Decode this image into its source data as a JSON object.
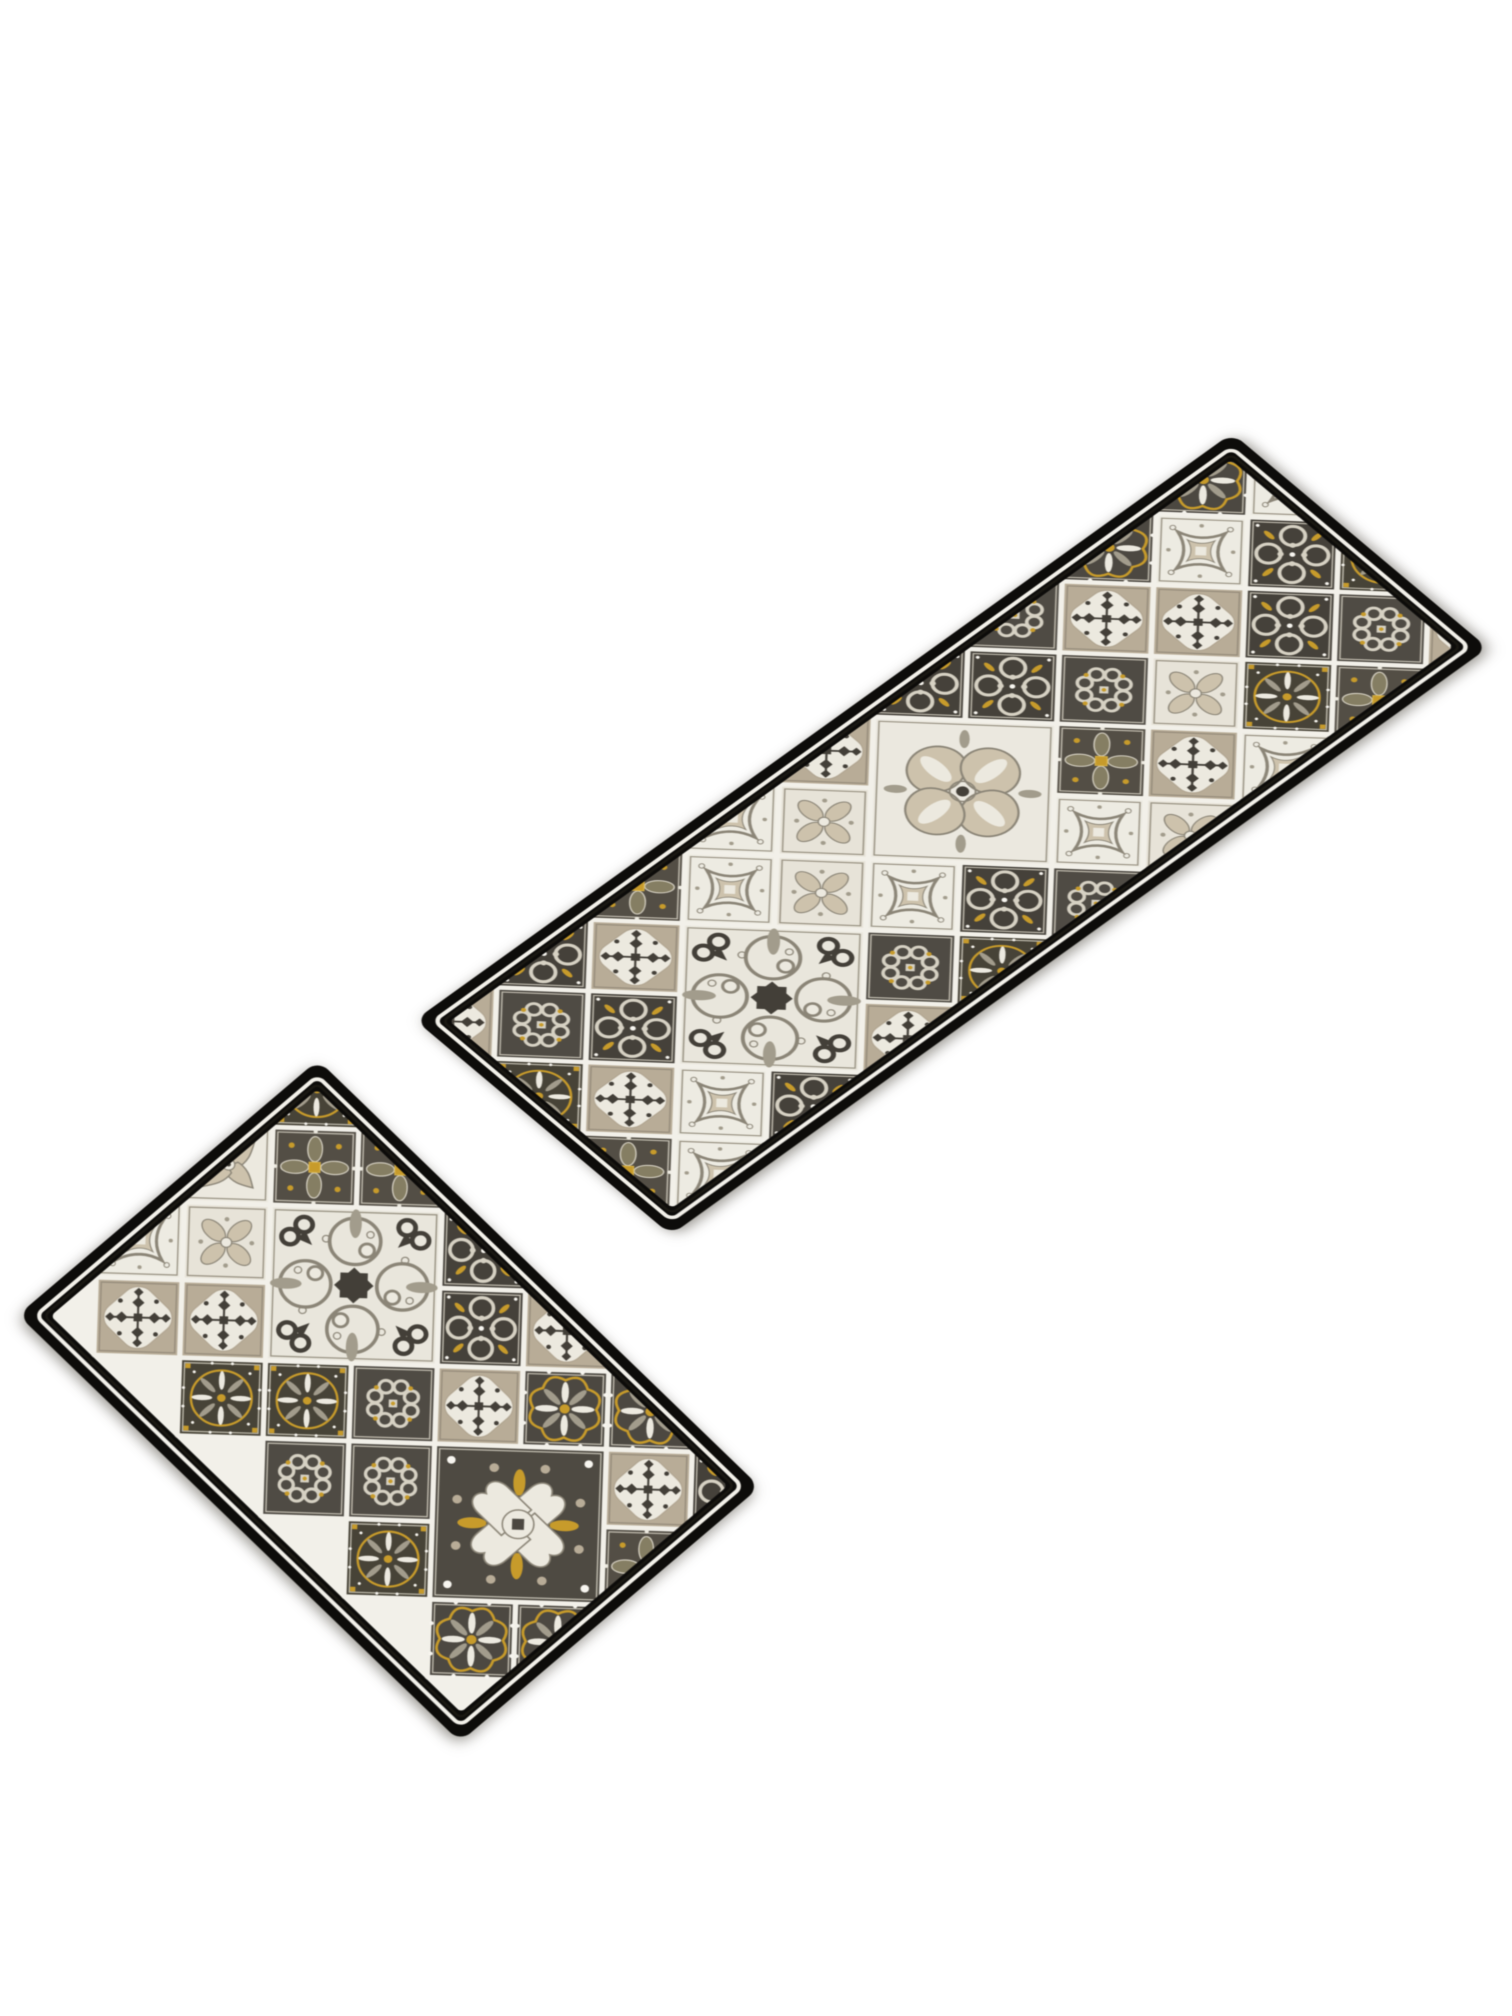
{
  "scene": {
    "subject": "two-piece kitchen mat / runner rug set with patchwork azulejo tile pattern",
    "background": "#ffffff",
    "width": 1512,
    "height": 2016
  },
  "palette": {
    "border_black": "#0d0c0a",
    "inner_line": "#1a1812",
    "grout": "#f2f0e9",
    "dark": "#4c4841",
    "dark2": "#433f38",
    "dark3": "#45413a",
    "dark4": "#4f4b44",
    "dark5": "#534e45",
    "dark6": "#4e4a42",
    "dark7": "#474337",
    "beige": "#b8ac97",
    "beige2": "#cdc2ac",
    "cream": "#ece9df",
    "cream2": "#e7e3d8",
    "cream3": "#edebe2",
    "cream4": "#e9e6dc",
    "cream5": "#ebe8df",
    "gray": "#8b8577",
    "gray2": "#a29c8c",
    "gold": "#c79b2b",
    "gold2": "#dab54a",
    "olive": "#857e63",
    "white": "#f7f5ef",
    "edge_light": "#d6d1c3",
    "edge_dark": "#8a8272"
  },
  "tile": {
    "size": 116,
    "inset": 22,
    "grout_width": 5
  },
  "motif_legend": {
    "R": "scalloped-rosette-dark",
    "P": "gold-ring-rosette-dark",
    "S": "snowflake-beige",
    "W": "scrollwork-dark",
    "C": "cross-fleur-light",
    "G": "petal-cross-light",
    "Q": "diamond-square-light",
    "K": "clover-knot-dark",
    "F": "gold-floral-cross-dark",
    "X": "azulejo-cross-large-dark",
    "H": "swirl-hearts-large-light",
    "B": "big-cross-fleur-large-light",
    ".": "covered-by-large-tile"
  },
  "mats": [
    {
      "name": "runner-mat",
      "width": 1006,
      "height": 334,
      "corner_radius": 14,
      "matrix": [
        0.8122,
        -0.5835,
        0.7665,
        0.6437,
        415,
        1020
      ],
      "rows": [
        "SWFQSWKRRS",
        "KSQG.WSQQS",
        "PW.G..KSWF",
        "S..Q.FGWPS",
        "FQ.KWQSPKQ",
        "QWSPKGQFSW"
      ],
      "large": [
        {
          "type": "H",
          "x": 254,
          "y": 196
        },
        {
          "type": "B",
          "x": 544,
          "y": 138
        }
      ]
    },
    {
      "name": "accent-mat",
      "width": 615,
      "height": 394,
      "corner_radius": 14,
      "matrix": [
        0.7187,
        0.6943,
        -0.7614,
        0.6472,
        318,
        1060
      ],
      "rows": [
        "PFWSRW",
        "F.WRSW",
        "C..S.F",
        "G.K..Q",
        "QSPK.R",
        "SPKPRW"
      ],
      "large": [
        {
          "type": "H",
          "x": 196,
          "y": 138
        },
        {
          "type": "X",
          "x": 486,
          "y": 196
        }
      ]
    }
  ]
}
